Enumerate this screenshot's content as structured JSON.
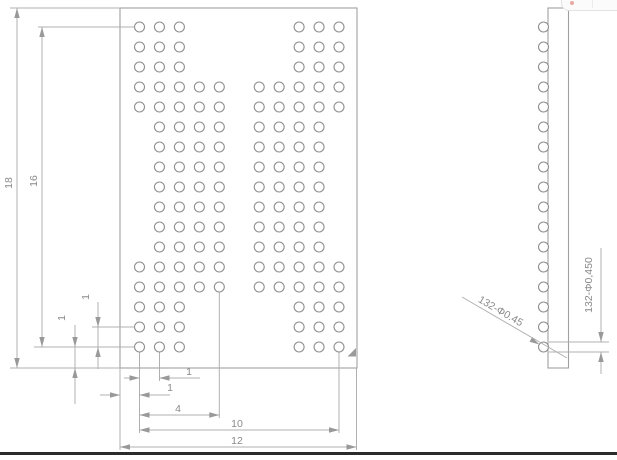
{
  "drawing": {
    "type": "bga-package-technical-drawing",
    "labels": {
      "plan_height": "18",
      "ball_span_vertical": "16",
      "pitch_vertical": "1",
      "edge_offset_vertical": "1",
      "pitch_horizontal": "1",
      "edge_offset_horizontal": "1",
      "span_col1_to_col5": "4",
      "ball_span_horizontal": "10",
      "plan_width": "12",
      "ball_callout_leader": "132-Φ0.45",
      "ball_diameter_dim": "132-Φ0,450"
    },
    "plan_view": {
      "package_width": 12,
      "package_height": 18,
      "ball_grid": {
        "pitch": 1,
        "columns": 11,
        "rows": 17,
        "total_balls": 132,
        "ball_diameter": 0.45,
        "row_patterns": [
          {
            "rows": [
              1,
              2,
              3
            ],
            "cols": [
              1,
              2,
              3,
              9,
              10,
              11
            ]
          },
          {
            "rows": [
              4,
              5
            ],
            "cols": [
              1,
              2,
              3,
              4,
              5,
              7,
              8,
              9,
              10,
              11
            ]
          },
          {
            "rows": [
              6,
              7,
              8,
              9,
              10,
              11,
              12
            ],
            "cols": [
              2,
              3,
              4,
              5,
              7,
              8,
              9,
              10
            ]
          },
          {
            "rows": [
              13,
              14
            ],
            "cols": [
              1,
              2,
              3,
              4,
              5,
              7,
              8,
              9,
              10,
              11
            ]
          },
          {
            "rows": [
              15,
              16,
              17
            ],
            "cols": [
              1,
              2,
              3,
              9,
              10,
              11
            ]
          }
        ]
      },
      "pin1_marker": "triangle-bottom-right"
    },
    "side_view": {
      "ball_rows": 17
    },
    "colors": {
      "line": "#b0b0b0",
      "outline": "#a0a0a0",
      "ball_stroke": "#8f8f8f",
      "text": "#8a8a8a",
      "marker_fill": "#9a9a9a",
      "bottom_bar": "#2b2b2b",
      "remnant_dot": "#e59a92"
    }
  }
}
